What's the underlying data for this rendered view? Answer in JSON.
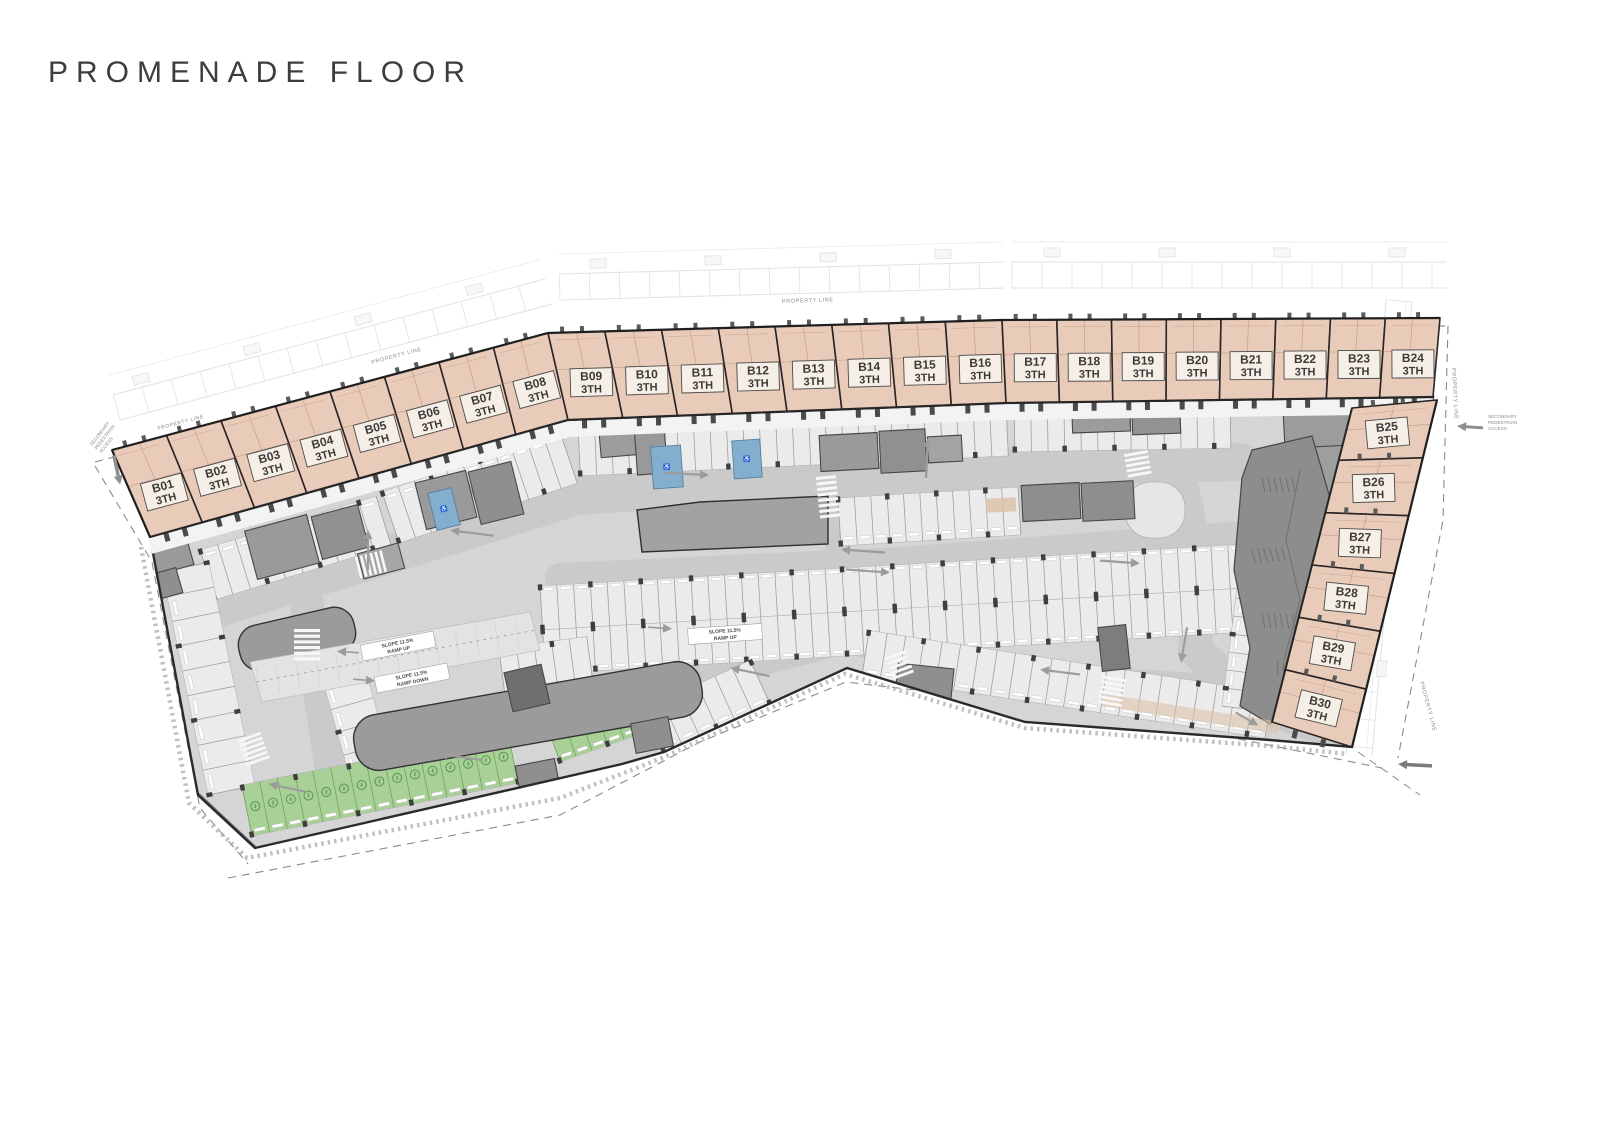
{
  "title": "PROMENADE FLOOR",
  "unit_type_label": "3TH",
  "units": {
    "top_row": [
      "B01",
      "B02",
      "B03",
      "B04",
      "B05",
      "B06",
      "B07",
      "B08",
      "B09",
      "B10",
      "B11",
      "B12",
      "B13",
      "B14",
      "B15",
      "B16",
      "B17",
      "B18",
      "B19",
      "B20",
      "B21",
      "B22",
      "B23",
      "B24"
    ],
    "right_column": [
      "B25",
      "B26",
      "B27",
      "B28",
      "B29",
      "B30"
    ]
  },
  "labels": {
    "property_line": "PROPERTY LINE",
    "secondary_access_lines": [
      "SECONDARY",
      "PEDESTRIAN",
      "ACCESS"
    ],
    "ramp_up_l1": "SLOPE 11.5%",
    "ramp_up_l2": "RAMP UP",
    "ramp_down_l1": "SLOPE 11.5%",
    "ramp_down_l2": "RAMP DOWN"
  },
  "colors": {
    "unit_fill": "#e9cbb9",
    "unit_line": "#b48a77",
    "unit_border": "#2b2526",
    "label_box": "#f6efe8",
    "label_text": "#3f3a38",
    "floor": "#d5d5d5",
    "stall": "#ebebeb",
    "aisle": "#cacaca",
    "walkway": "#f3f3f3",
    "core": "#989898",
    "core_dark": "#6f6f6f",
    "green": "#a9d096",
    "green_dark": "#55984a",
    "blue": "#84aecd",
    "outline": "#2a2a2a",
    "context": "#c4c4c4",
    "arrow": "#9c9c9c",
    "tan": "#dcc3ac",
    "note_text": "#8a8a8a"
  }
}
